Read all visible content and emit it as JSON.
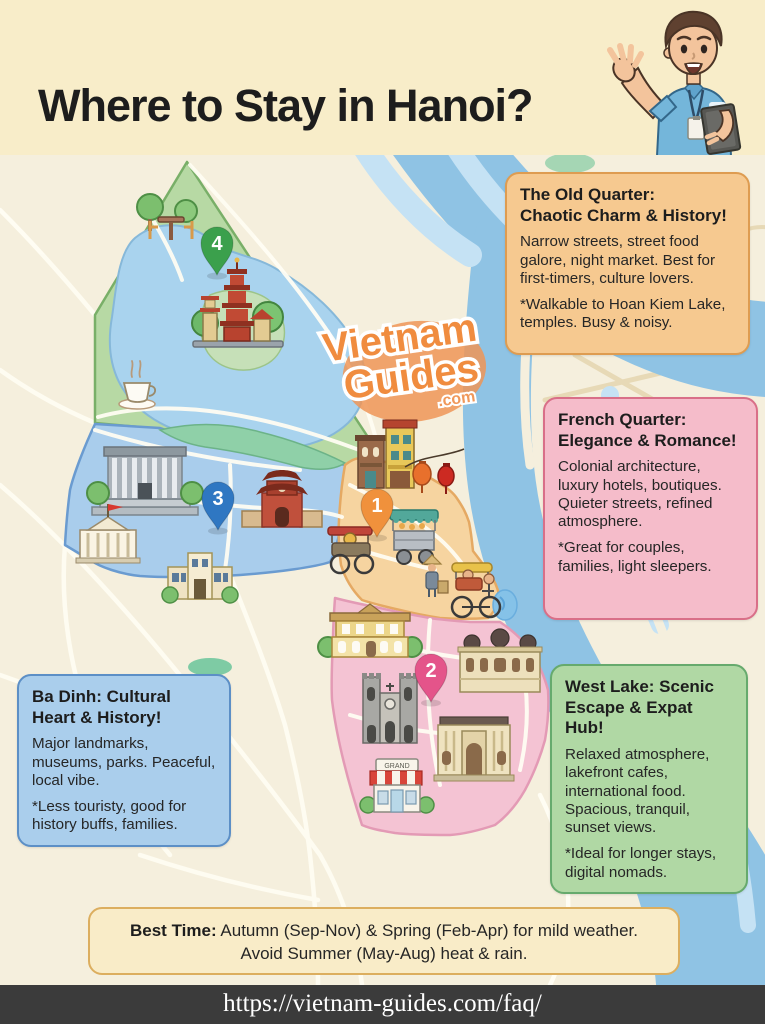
{
  "header": {
    "title": "Where to Stay in Hanoi?",
    "mascot_icon": "tour-guide-man-icon"
  },
  "map": {
    "watermark": {
      "line1": "Vietnam",
      "line2": "Guides",
      "line3": ".com"
    },
    "boutique_sign": "GRAND",
    "pins": [
      {
        "number": "1",
        "district": "old-quarter",
        "color": "#f0913c"
      },
      {
        "number": "2",
        "district": "french-quarter",
        "color": "#e4548a"
      },
      {
        "number": "3",
        "district": "ba-dinh",
        "color": "#2f77c2"
      },
      {
        "number": "4",
        "district": "west-lake",
        "color": "#3ba04c"
      }
    ],
    "landmark_icons": [
      "tran-quoc-pagoda-icon",
      "cafe-table-icon",
      "coffee-cup-icon",
      "ho-chi-minh-mausoleum-icon",
      "presidential-palace-icon",
      "temple-of-literature-icon",
      "museum-icon",
      "shophouses-icon",
      "red-lanterns-icon",
      "cyclo-carriage-icon",
      "street-food-cart-icon",
      "street-vendor-icon",
      "pedicab-icon",
      "colonial-villa-icon",
      "domed-palace-icon",
      "cathedral-icon",
      "opera-house-icon",
      "boutique-shop-icon"
    ],
    "region_colors": {
      "west_lake_green": "#b7d9a4",
      "ba_dinh_blue": "#a9cdec",
      "old_quarter_orange": "#f6d4a0",
      "french_quarter_pink": "#f4c3d3",
      "river_blue": "#8fc3e4",
      "lake_blue": "#a9d3ee"
    }
  },
  "callouts": {
    "old_quarter": {
      "title": "The Old Quarter:\nChaotic Charm & History!",
      "body": "Narrow streets, street food galore, night market. Best for first-timers, culture lovers.",
      "note": "*Walkable to Hoan Kiem Lake, temples. Busy & noisy.",
      "bg": "#f6c990",
      "border": "#de9c51"
    },
    "french_quarter": {
      "title": "French Quarter:\nElegance & Romance!",
      "body": "Colonial architecture, luxury hotels, boutiques. Quieter streets, refined atmosphere.",
      "note": "*Great for couples, families, light sleepers.",
      "bg": "#f5bcca",
      "border": "#d96f88"
    },
    "ba_dinh": {
      "title": "Ba Dinh: Cultural\nHeart & History!",
      "body": "Major landmarks, museums, parks. Peaceful, local vibe.",
      "note": "*Less touristy, good for history buffs, families.",
      "bg": "#aaceec",
      "border": "#5c8fc6"
    },
    "west_lake": {
      "title": "West Lake: Scenic\nEscape & Expat Hub!",
      "body": "Relaxed atmosphere, lakefront cafes, international food. Spacious, tranquil, sunset views.",
      "note": "*Ideal for longer stays, digital nomads.",
      "bg": "#b0d8a4",
      "border": "#66aa6d"
    }
  },
  "best_time": {
    "label": "Best Time:",
    "line1_rest": " Autumn (Sep-Nov) & Spring (Feb-Apr) for mild weather.",
    "line2": "Avoid Summer (May-Aug) heat & rain.",
    "bg": "#f9ecc8",
    "border": "#dcae5f"
  },
  "footer": {
    "url": "https://vietnam-guides.com/faq/"
  }
}
